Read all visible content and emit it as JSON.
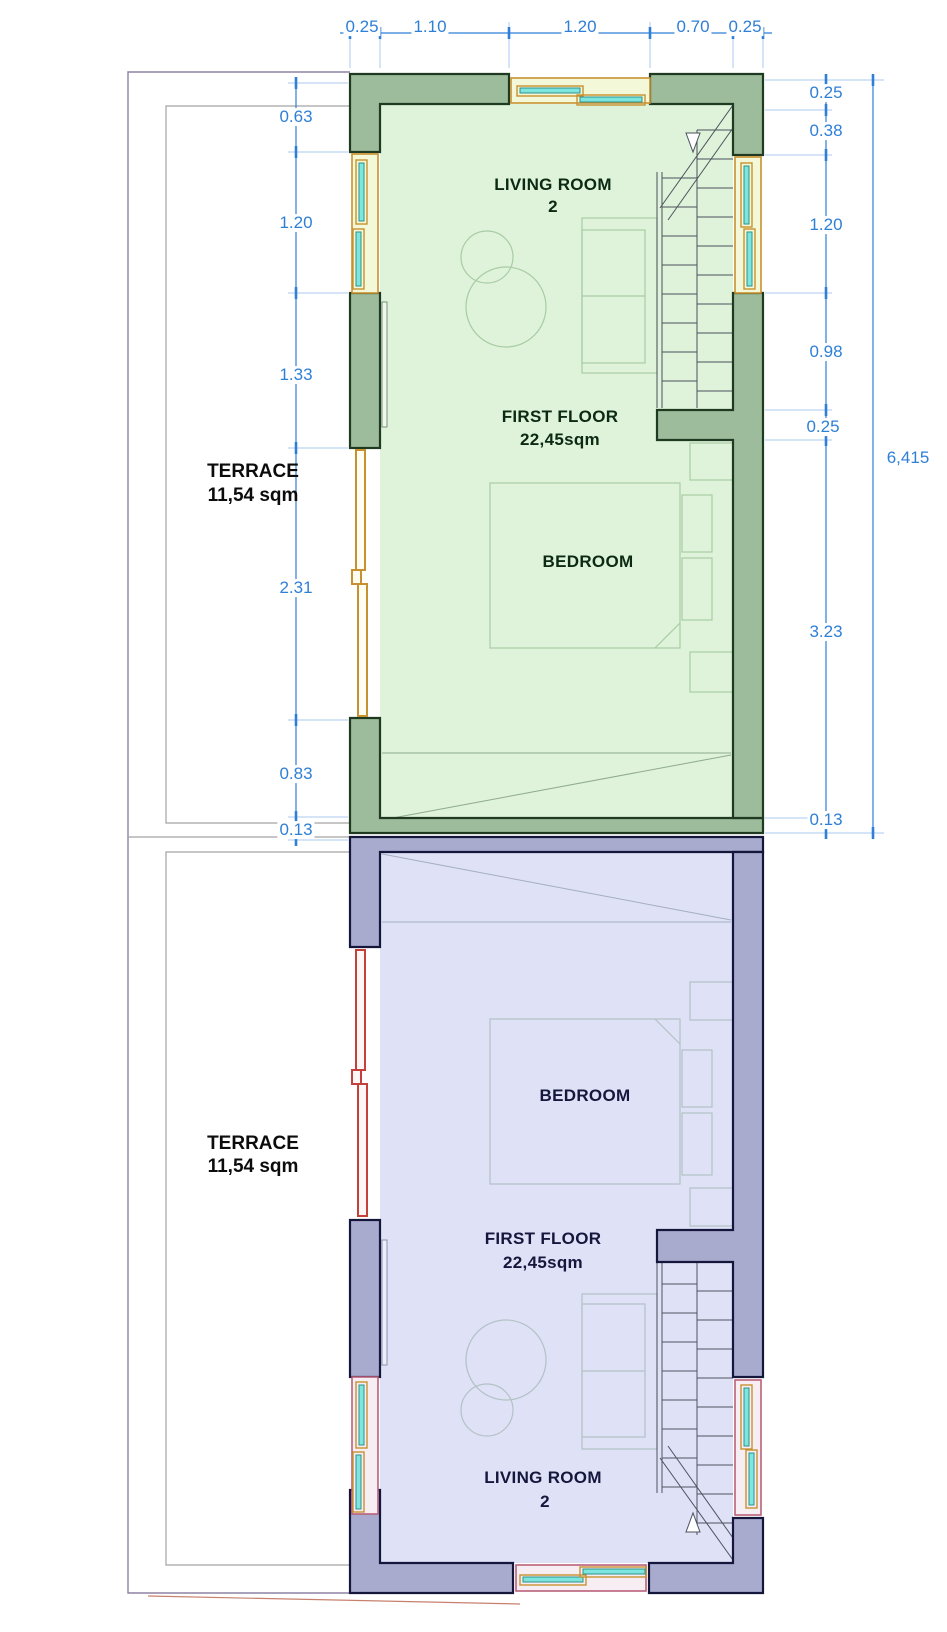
{
  "colors": {
    "dimension_blue": "#2e7fd6",
    "wall_green_fill": "#9cbc9c",
    "wall_green_stroke": "#1f3a20",
    "room_green_fill": "#def3d9",
    "label_green": "#0c2913",
    "furniture_green": "#a9cba5",
    "wall_lavender_fill": "#a9abce",
    "wall_lavender_stroke": "#15163c",
    "room_lavender_fill": "#dfe1f6",
    "label_lavender": "#15173d",
    "furniture_lavender": "#b3c2c4",
    "window_frame_orange": "#c8912f",
    "window_frame_pink": "#b9607a",
    "window_glass_cyan": "#7de6de",
    "door_red": "#c4403a",
    "terrace_outline": "#a3a3a3",
    "stair_line": "#4c525e",
    "ground_line_red": "#c8806e"
  },
  "dimensions": {
    "top": [
      "0.25",
      "1.10",
      "1.20",
      "0.70",
      "0.25"
    ],
    "left": [
      "0.63",
      "1.20",
      "1.33",
      "2.31",
      "0.83",
      "0.13"
    ],
    "right": [
      "0.25",
      "0.38",
      "1.20",
      "0.98",
      "0.25",
      "3.23",
      "0.13"
    ],
    "overall_height": "6,415"
  },
  "upper_unit": {
    "living_room_label": "LIVING ROOM",
    "living_room_number": "2",
    "floor_label": "FIRST FLOOR",
    "floor_area": "22,45sqm",
    "bedroom_label": "BEDROOM",
    "terrace_label": "TERRACE",
    "terrace_area": "11,54 sqm"
  },
  "lower_unit": {
    "living_room_label": "LIVING ROOM",
    "living_room_number": "2",
    "floor_label": "FIRST FLOOR",
    "floor_area": "22,45sqm",
    "bedroom_label": "BEDROOM",
    "terrace_label": "TERRACE",
    "terrace_area": "11,54 sqm"
  }
}
